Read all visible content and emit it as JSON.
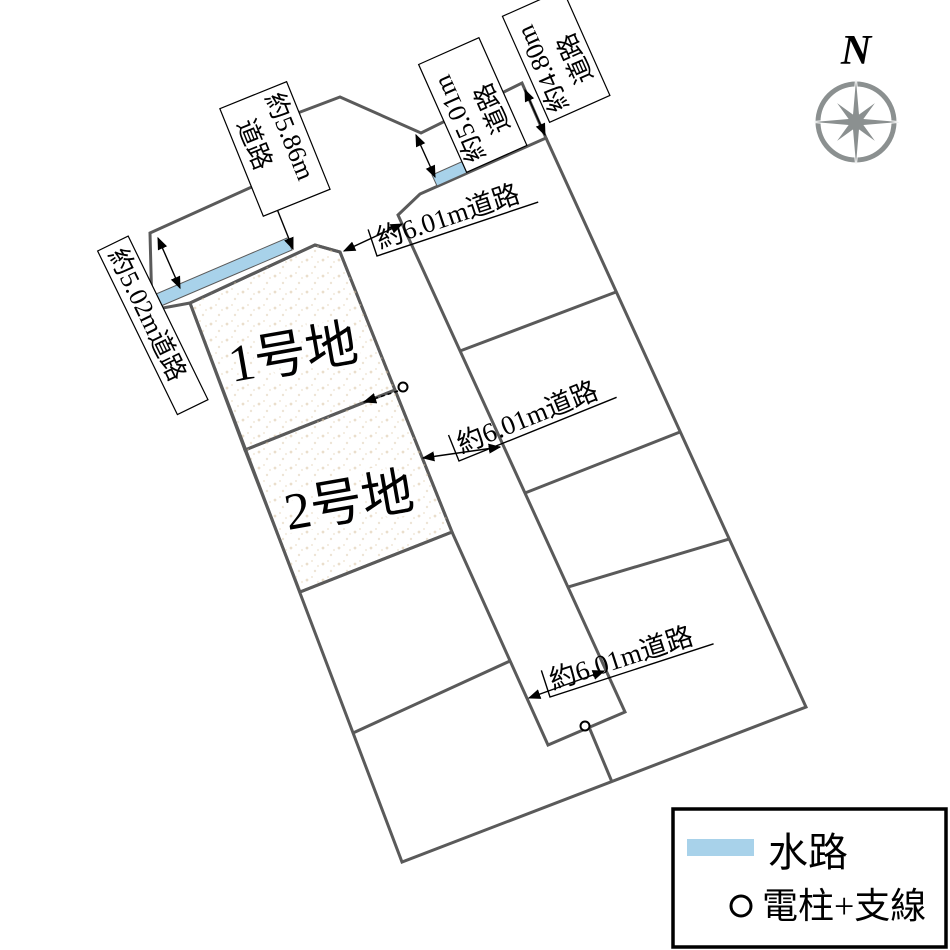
{
  "colors": {
    "road": "#d9d6c6",
    "lot": "#ecdec4",
    "lot_speckle": "#d8c3a2",
    "water": "#a8d2ea",
    "line": "#5a5a5a",
    "compass": "#8b9090",
    "label_bg": "#ffffff"
  },
  "lots": {
    "lot1": "1号地",
    "lot2": "2号地"
  },
  "road_labels": {
    "w502": "約5.02m道路",
    "w586_line1": "約5.86m",
    "w586_line2": "道路",
    "w501_line1": "約5.01m",
    "w501_line2": "道路",
    "w480_line1": "約4.80m",
    "w480_line2": "道路",
    "w601_top": "約6.01m道路",
    "w601_mid": "約6.01m道路",
    "w601_bot": "約6.01m道路"
  },
  "legend": {
    "water_label": "水路",
    "pole_label": "電柱+支線"
  },
  "compass": {
    "label": "N"
  }
}
